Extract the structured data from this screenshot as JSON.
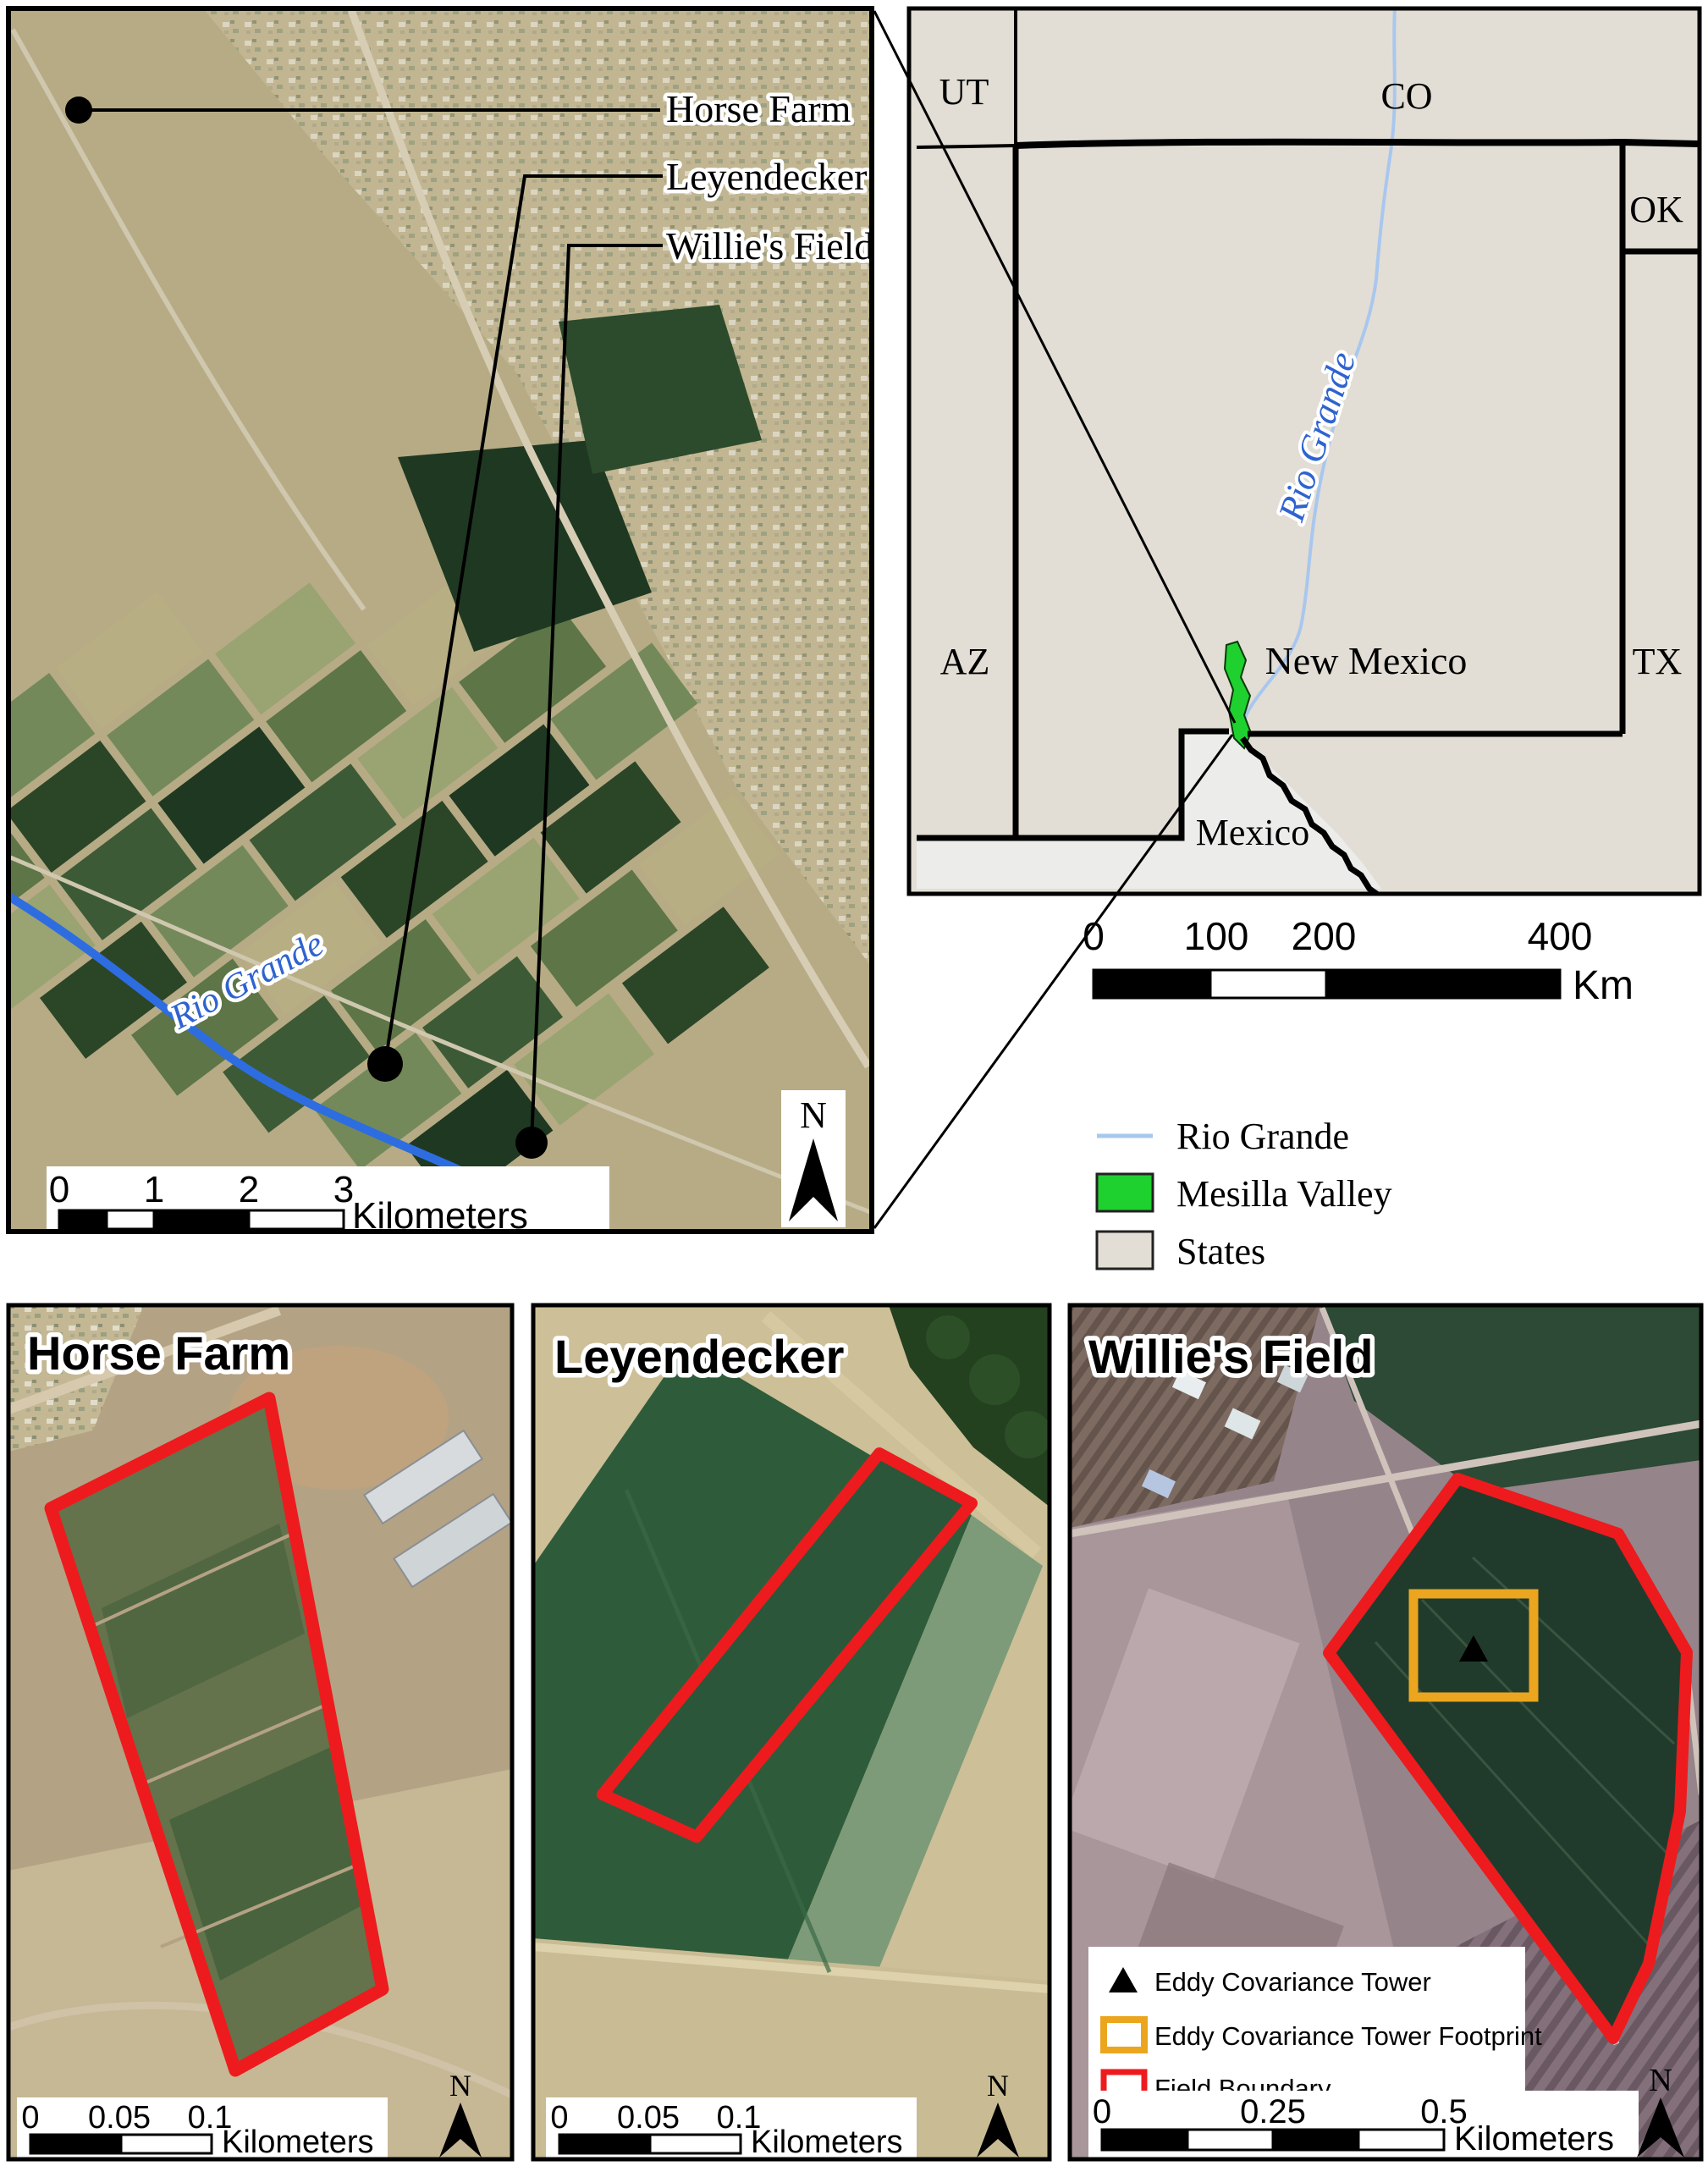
{
  "figure_title": "Study site location maps",
  "main_map": {
    "site_labels": [
      "Horse Farm",
      "Leyendecker",
      "Willie's Field"
    ],
    "river_label": "Rio Grande",
    "north_label": "N",
    "scale_bar": {
      "ticks": [
        "0",
        "1",
        "2",
        "3"
      ],
      "unit": "Kilometers"
    }
  },
  "inset_map": {
    "state_labels": {
      "ut": "UT",
      "co": "CO",
      "ok": "OK",
      "az": "AZ",
      "nm": "New Mexico",
      "tx": "TX"
    },
    "country_label": "Mexico",
    "river_label": "Rio Grande",
    "scale_bar": {
      "ticks": [
        "0",
        "100",
        "200",
        "400"
      ],
      "unit": "Km"
    },
    "legend": {
      "items": [
        {
          "label": "Rio Grande",
          "symbol": "river-line",
          "color": "#a9c7ee"
        },
        {
          "label": "Mesilla Valley",
          "symbol": "filled-box",
          "color": "#1fd12f"
        },
        {
          "label": "States",
          "symbol": "filled-box",
          "color": "#e2ded5"
        }
      ]
    }
  },
  "site_panels": [
    {
      "title": "Horse Farm",
      "north_label": "N",
      "scale_bar": {
        "ticks": [
          "0",
          "0.05",
          "0.1"
        ],
        "unit": "Kilometers"
      }
    },
    {
      "title": "Leyendecker",
      "north_label": "N",
      "scale_bar": {
        "ticks": [
          "0",
          "0.05",
          "0.1"
        ],
        "unit": "Kilometers"
      }
    },
    {
      "title": "Willie's Field",
      "north_label": "N",
      "scale_bar": {
        "ticks": [
          "0",
          "0.25",
          "0.5"
        ],
        "unit": "Kilometers"
      },
      "legend": {
        "items": [
          {
            "label": "Eddy Covariance Tower",
            "symbol": "triangle",
            "color": "#000000"
          },
          {
            "label": "Eddy Covariance Tower Footprint",
            "symbol": "square-outline",
            "color": "#eba51e"
          },
          {
            "label": "Field Boundary",
            "symbol": "square-outline",
            "color": "#ed1b1d"
          }
        ]
      }
    }
  ],
  "colors": {
    "field_boundary": "#ed1b1d",
    "tower_footprint": "#eba51e",
    "mesilla_valley": "#1fd12f",
    "river_main_map": "#2e6de0",
    "river_inset": "#a9c7ee",
    "states_fill": "#e2ded5",
    "mexico_fill": "#ececea"
  }
}
